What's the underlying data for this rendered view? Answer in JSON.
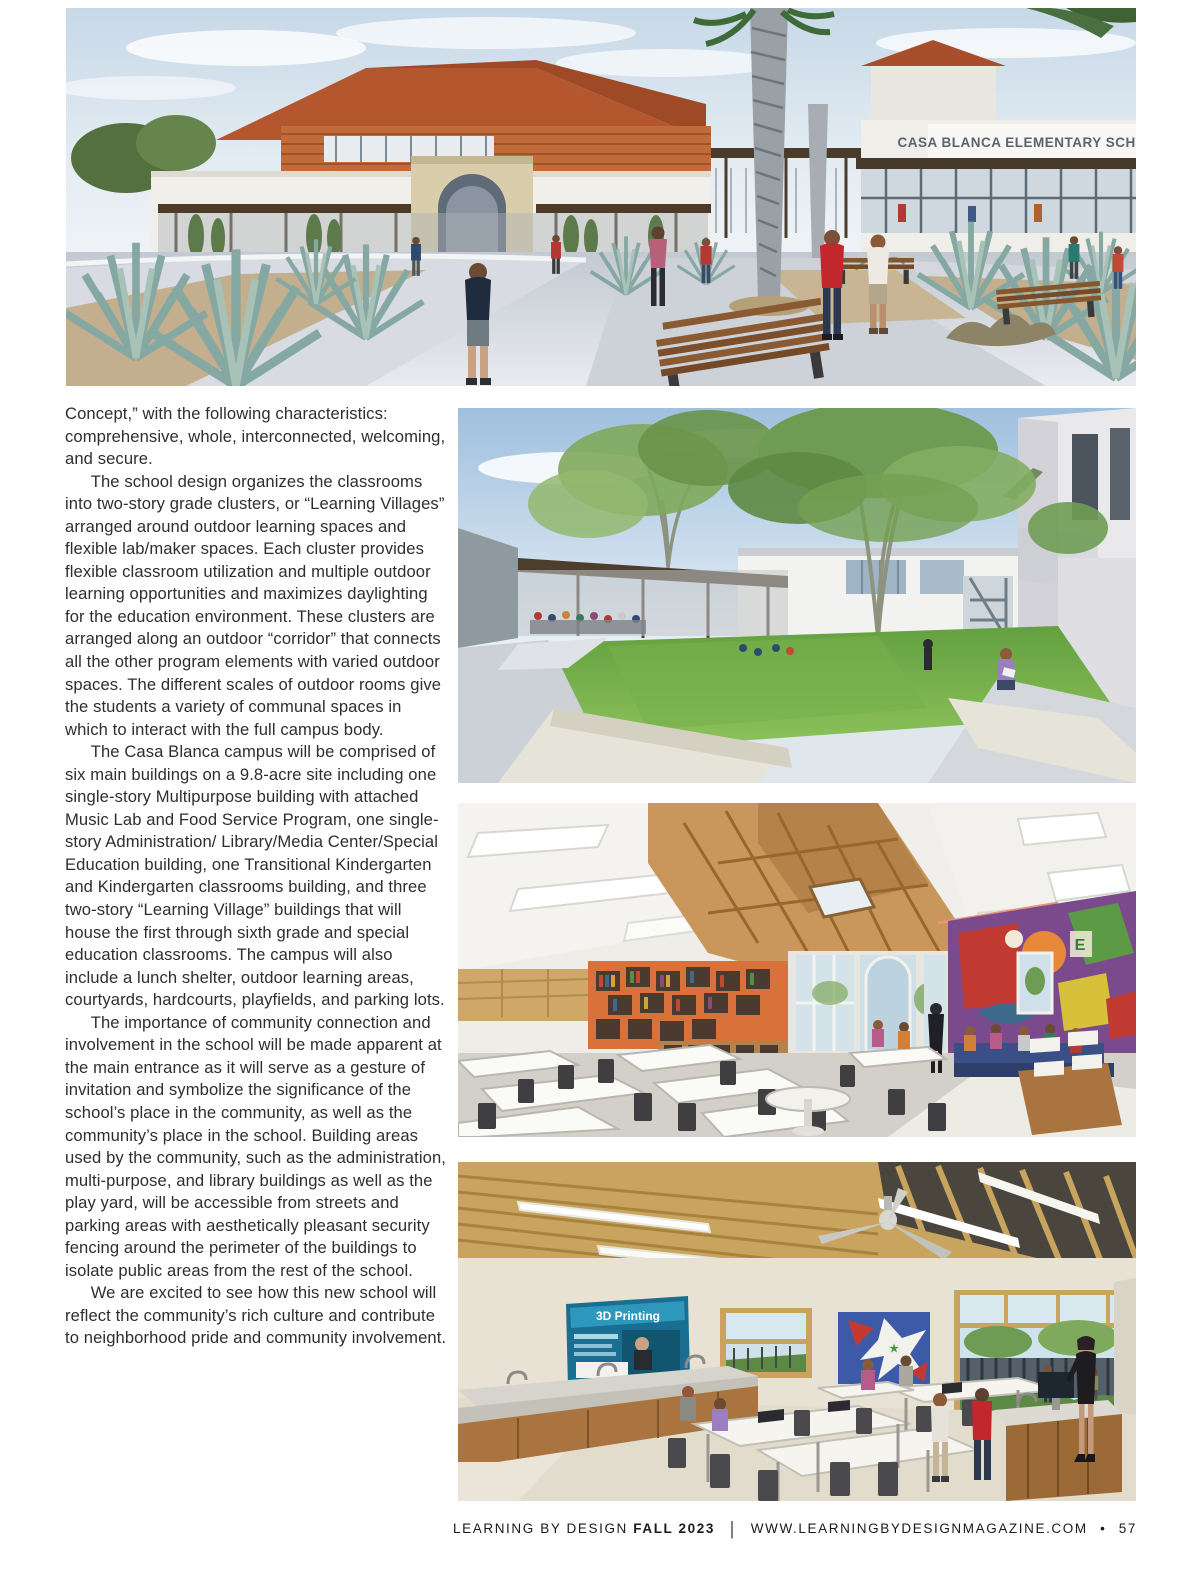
{
  "article": {
    "paragraphs": [
      "Concept,” with the following characteristics: comprehensive, whole, interconnected, welcoming, and secure.",
      "The school design organizes the classrooms into two-story grade clusters, or “Learning Villages” arranged around outdoor learning spaces and flexible lab/maker spaces. Each cluster provides flexible classroom utilization and multiple outdoor learning opportunities and maximizes daylighting for the education environment. These clusters are arranged along an outdoor “corridor” that connects all the other program elements with varied outdoor spaces. The different scales of outdoor rooms give the students a variety of communal spaces in which to interact with the full campus body.",
      "The Casa Blanca campus will be comprised of six main buildings on a 9.8-acre site including one single-story Multipurpose building with attached Music Lab and Food Service Program, one single-story Administration/ Library/Media Center/Special Education building, one Transitional Kindergarten and Kindergarten classrooms building, and three two-story “Learning Village” buildings that will house the first through sixth grade and special education classrooms. The campus will also include a lunch shelter, outdoor learning areas, courtyards, hardcourts, playfields, and parking lots.",
      "The importance of community connection and involvement in the school will be made apparent at the main entrance as it will serve as a gesture of invitation and symbolize the significance of the school’s place in the community, as well as the community’s place in the school. Building areas used by the community, such as the administration, multi-purpose, and library buildings as well as the play yard, will be accessible from streets and parking areas with aesthetically pleasant security fencing around the perimeter of the buildings to isolate public areas from the rest of the school.",
      "We are excited to see how this new school will reflect the community’s rich culture and contribute to neighborhood pride and community involvement."
    ]
  },
  "hero": {
    "sign_text": "CASA BLANCA ELEMENTARY SCHOOL"
  },
  "lab": {
    "poster_title": "3D Printing"
  },
  "footer": {
    "magazine": "LEARNING BY DESIGN",
    "issue": "FALL 2023",
    "separator": "|",
    "website": "WWW.LEARNINGBYDESIGNMAGAZINE.COM",
    "bullet": "•",
    "page_number": "57"
  },
  "colors": {
    "page_bg": "#ffffff",
    "body_text": "#2e2e30",
    "footer_text": "#1a1a1a"
  }
}
